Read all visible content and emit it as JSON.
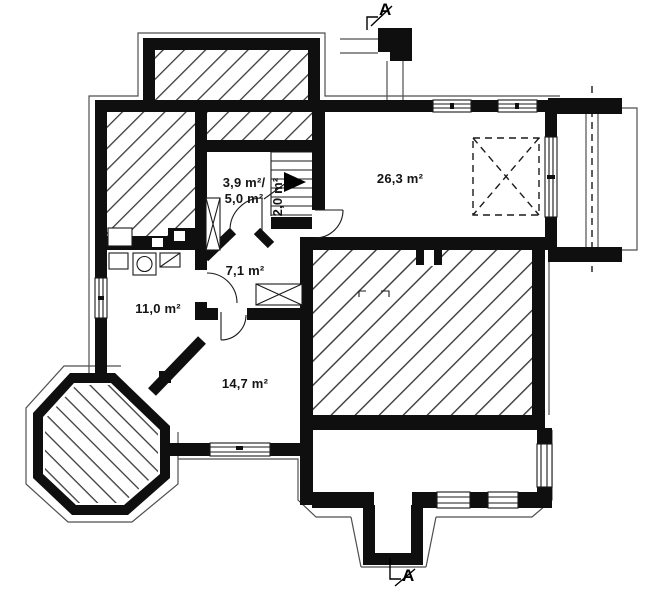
{
  "plan": {
    "section_markers": {
      "top": "A",
      "bottom": "A"
    },
    "room_labels": {
      "small_room_line1": "3,9 m²/",
      "small_room_line2": "5,0 m²",
      "stair_area": "2,0 m²",
      "hallway": "7,1 m²",
      "living_area": "26,3 m²",
      "utility_room": "11,0 m²",
      "rec_room": "14,7 m²"
    },
    "colors": {
      "wall": "#0f0f0f",
      "line": "#1a1a1a",
      "thin": "#4f4f4f",
      "hatch": "#3a3a3a",
      "bg": "#ffffff"
    }
  }
}
